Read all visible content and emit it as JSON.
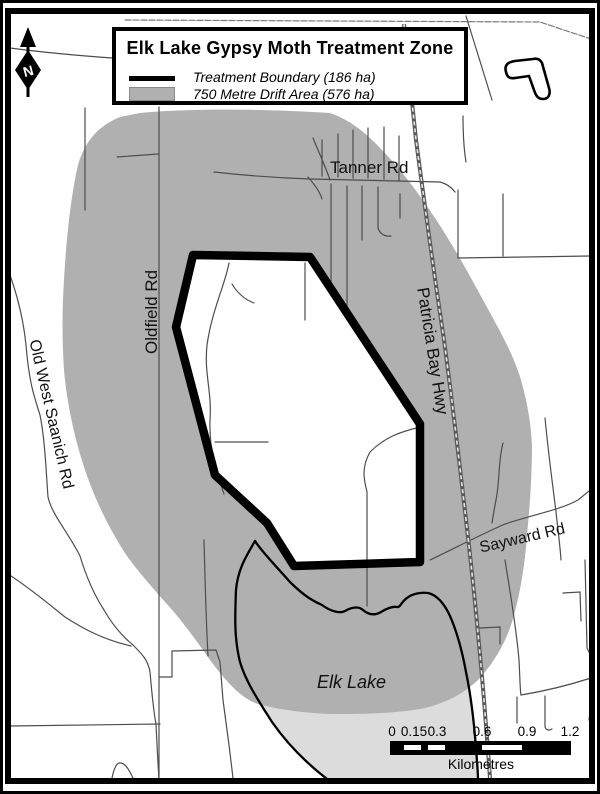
{
  "map": {
    "title": "Elk Lake Gypsy Moth Treatment Zone",
    "legend": [
      {
        "swatch": "thick-black-line",
        "label": "Treatment Boundary (186 ha)"
      },
      {
        "swatch": "gray-fill",
        "label": "750 Metre Drift Area (576 ha)"
      }
    ],
    "north_arrow": {
      "label": "N"
    },
    "road_labels": {
      "tanner": "Tanner Rd",
      "oldfield": "Oldfield Rd",
      "patricia_bay": "Patricia Bay Hwy",
      "old_west_saanich": "Old West Saanich Rd",
      "sayward": "Sayward Rd"
    },
    "water_labels": {
      "elk_lake": "Elk Lake"
    },
    "scale_bar": {
      "ticks": [
        "0",
        "0.15",
        "0.3",
        "0.6",
        "0.9",
        "1.2"
      ],
      "unit_label": "Kilometres"
    },
    "colors": {
      "drift_area": "#b0b0b0",
      "lake": "#dcdcdc",
      "treatment_boundary": "#000000",
      "road": "#4d4d4d"
    }
  }
}
